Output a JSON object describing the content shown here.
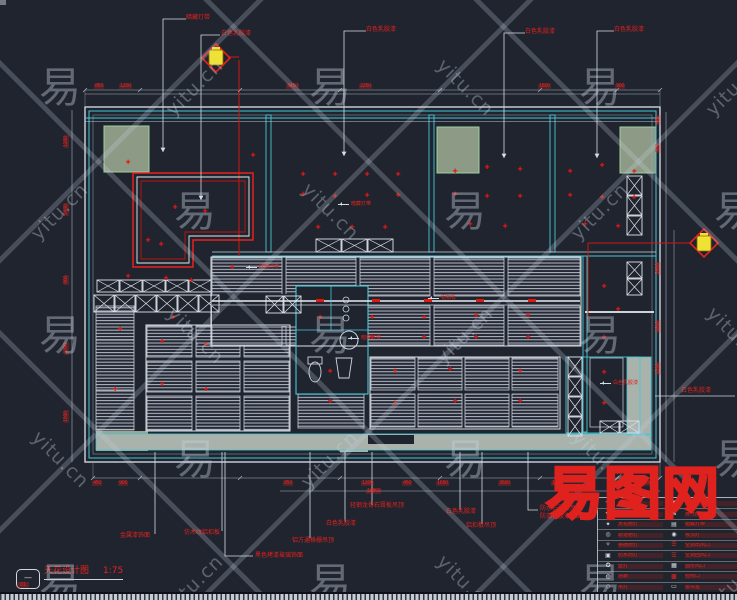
{
  "logo": {
    "text": "易图网"
  },
  "watermark": {
    "brand": "yitu.cn",
    "char": "易"
  },
  "title_block": {
    "icon_label": "—",
    "title": "天花设计图",
    "scale": "1:75",
    "sub": "01"
  },
  "top_labels": [
    {
      "text": "暗藏灯带",
      "x": 186,
      "y": 15
    },
    {
      "text": "白色乳胶漆",
      "x": 221,
      "y": 31
    },
    {
      "text": "白色乳胶漆",
      "x": 366,
      "y": 27
    },
    {
      "text": "白色乳胶漆",
      "x": 525,
      "y": 29
    },
    {
      "text": "白色乳胶漆",
      "x": 614,
      "y": 27
    }
  ],
  "side_labels": [
    {
      "text": "白色乳胶漆",
      "x": 681,
      "y": 388
    }
  ],
  "bottom_labels": [
    {
      "text": "金属漆饰面",
      "x": 120,
      "y": 533
    },
    {
      "text": "仿木纹铝扣板",
      "x": 184,
      "y": 530
    },
    {
      "text": "黑色烤漆玻璃饰面",
      "x": 255,
      "y": 553
    },
    {
      "text": "铝方通格栅吊顶",
      "x": 292,
      "y": 538
    },
    {
      "text": "白色乳胶漆",
      "x": 326,
      "y": 521
    },
    {
      "text": "轻钢龙骨石膏板吊顶",
      "x": 350,
      "y": 503
    },
    {
      "text": "白色乳胶漆",
      "x": 446,
      "y": 509
    },
    {
      "text": "铝扣板吊顶",
      "x": 466,
      "y": 523
    },
    {
      "text": "防水石膏板吊顶",
      "x": 540,
      "y": 506
    },
    {
      "text": "防潮乳胶漆饰面",
      "x": 540,
      "y": 514
    }
  ],
  "inner_labels": [
    {
      "text": "暗藏灯带",
      "x": 338,
      "y": 202
    },
    {
      "text": "铝扣板",
      "x": 428,
      "y": 296
    },
    {
      "text": "暗藏灯带",
      "x": 348,
      "y": 336
    },
    {
      "text": "白色乳胶漆",
      "x": 600,
      "y": 381
    },
    {
      "text": "暗藏灯带",
      "x": 246,
      "y": 265
    }
  ],
  "dims": {
    "top": [
      {
        "v": "850",
        "x": 94
      },
      {
        "v": "1200",
        "x": 119
      },
      {
        "v": "3450",
        "x": 286
      },
      {
        "v": "2250",
        "x": 359
      },
      {
        "v": "1800",
        "x": 538
      },
      {
        "v": "900",
        "x": 615
      }
    ],
    "bottom": [
      {
        "v": "450",
        "x": 92
      },
      {
        "v": "900",
        "x": 118
      },
      {
        "v": "850",
        "x": 283
      },
      {
        "v": "1200",
        "x": 361
      },
      {
        "v": "450",
        "x": 402
      },
      {
        "v": "1650",
        "x": 436
      },
      {
        "v": "3600",
        "x": 498
      },
      {
        "v": "1350",
        "x": 551
      },
      {
        "v": "900",
        "x": 585
      },
      {
        "v": "1500",
        "x": 640
      }
    ],
    "bottom2": [
      {
        "v": "16800",
        "x": 366
      }
    ],
    "left": [
      {
        "v": "1200",
        "y": 148
      },
      {
        "v": "2400",
        "y": 216
      },
      {
        "v": "900",
        "y": 285
      },
      {
        "v": "3300",
        "y": 355
      },
      {
        "v": "1500",
        "y": 423
      }
    ],
    "right": [
      {
        "v": "600",
        "y": 125
      },
      {
        "v": "900",
        "y": 153
      },
      {
        "v": "2400",
        "y": 275
      },
      {
        "v": "1800",
        "y": 333
      },
      {
        "v": "1200",
        "y": 375
      }
    ]
  },
  "plan": {
    "downlight_glyph": "✚",
    "downlights": [
      [
        128,
        163
      ],
      [
        175,
        208
      ],
      [
        205,
        212
      ],
      [
        148,
        241
      ],
      [
        161,
        245
      ],
      [
        128,
        277
      ],
      [
        166,
        279
      ],
      [
        191,
        281
      ],
      [
        232,
        268
      ],
      [
        253,
        156
      ],
      [
        303,
        175
      ],
      [
        335,
        175
      ],
      [
        367,
        175
      ],
      [
        398,
        175
      ],
      [
        303,
        195
      ],
      [
        335,
        197
      ],
      [
        367,
        196
      ],
      [
        398,
        196
      ],
      [
        318,
        228
      ],
      [
        352,
        228
      ],
      [
        385,
        228
      ],
      [
        455,
        172
      ],
      [
        487,
        168
      ],
      [
        520,
        170
      ],
      [
        455,
        195
      ],
      [
        487,
        197
      ],
      [
        520,
        197
      ],
      [
        470,
        225
      ],
      [
        505,
        227
      ],
      [
        570,
        172
      ],
      [
        602,
        166
      ],
      [
        634,
        172
      ],
      [
        570,
        196
      ],
      [
        602,
        198
      ],
      [
        634,
        198
      ],
      [
        585,
        225
      ],
      [
        618,
        227
      ],
      [
        320,
        318
      ],
      [
        372,
        318
      ],
      [
        424,
        318
      ],
      [
        476,
        316
      ],
      [
        528,
        316
      ],
      [
        372,
        338
      ],
      [
        424,
        338
      ],
      [
        476,
        338
      ],
      [
        528,
        338
      ],
      [
        173,
        318
      ],
      [
        162,
        342
      ],
      [
        206,
        345
      ],
      [
        162,
        385
      ],
      [
        206,
        390
      ],
      [
        120,
        330
      ],
      [
        115,
        390
      ],
      [
        330,
        372
      ],
      [
        395,
        372
      ],
      [
        450,
        370
      ],
      [
        520,
        372
      ],
      [
        330,
        402
      ],
      [
        395,
        404
      ],
      [
        455,
        402
      ],
      [
        520,
        402
      ],
      [
        604,
        287
      ],
      [
        618,
        310
      ],
      [
        604,
        338
      ],
      [
        604,
        373
      ],
      [
        604,
        404
      ]
    ],
    "band_ticks": [
      [
        316,
        299
      ],
      [
        372,
        299
      ],
      [
        424,
        299
      ],
      [
        476,
        299
      ],
      [
        528,
        299
      ]
    ]
  },
  "legend": {
    "rows": [
      {
        "s1": "✛",
        "t1": "防雾筒灯",
        "s2": "▣",
        "t2": "烟感器",
        "s2red": false
      },
      {
        "s1": "✜",
        "t1": "明装筒灯",
        "s2": "⊠",
        "t2": "排气扇",
        "s2red": false
      },
      {
        "s1": "✦",
        "t1": "天花射灯",
        "s2": "▤",
        "t2": "暗藏灯带",
        "s2red": false
      },
      {
        "s1": "◎",
        "t1": "轨道射灯",
        "s2": "◉",
        "t2": "吸顶灯",
        "s2red": false
      },
      {
        "s1": "✧",
        "t1": "格栅射灯",
        "s2": "☰",
        "t2": "空调出风口",
        "s2red": true
      },
      {
        "s1": "▣",
        "t1": "防水筒灯",
        "s2": "☰",
        "t2": "空调回风口",
        "s2red": true
      },
      {
        "s1": "✪",
        "t1": "壁灯",
        "s2": "▦",
        "t2": "圆形风口",
        "s2red": false
      },
      {
        "s1": "◍",
        "t1": "浴霸",
        "s2": "▩",
        "t2": "检修口",
        "s2red": true
      },
      {
        "s1": "◇",
        "t1": "吊灯",
        "s2": "▭",
        "t2": "窗帘盒",
        "s2red": false
      }
    ]
  }
}
